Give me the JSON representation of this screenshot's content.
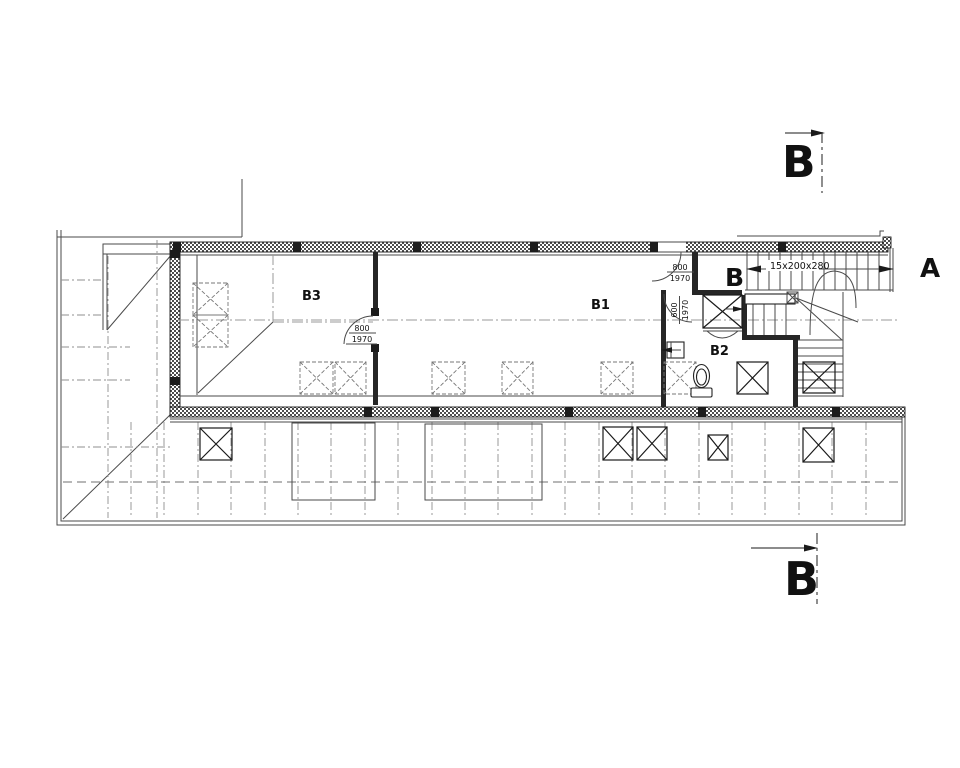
{
  "plan": {
    "colors": {
      "background": "#ffffff",
      "line": "#1a1a1a",
      "thin": "#4a4a4a",
      "centerline": "#9a9a9a",
      "grid": "#8f8f8f",
      "dashed": "#6f6f6f"
    },
    "section_markers": {
      "top": "B",
      "bottom": "B",
      "stair_inner": "B",
      "stair_outer": "A"
    },
    "rooms": {
      "b1": "B1",
      "b2": "B2",
      "b3": "B3"
    },
    "stair": {
      "annotation": "15x200x280"
    },
    "doors": {
      "entry": {
        "width": "800",
        "height": "1970"
      },
      "bathroom": {
        "width": "600",
        "height": "1970"
      },
      "room_b3": {
        "width": "800",
        "height": "1970"
      }
    }
  }
}
